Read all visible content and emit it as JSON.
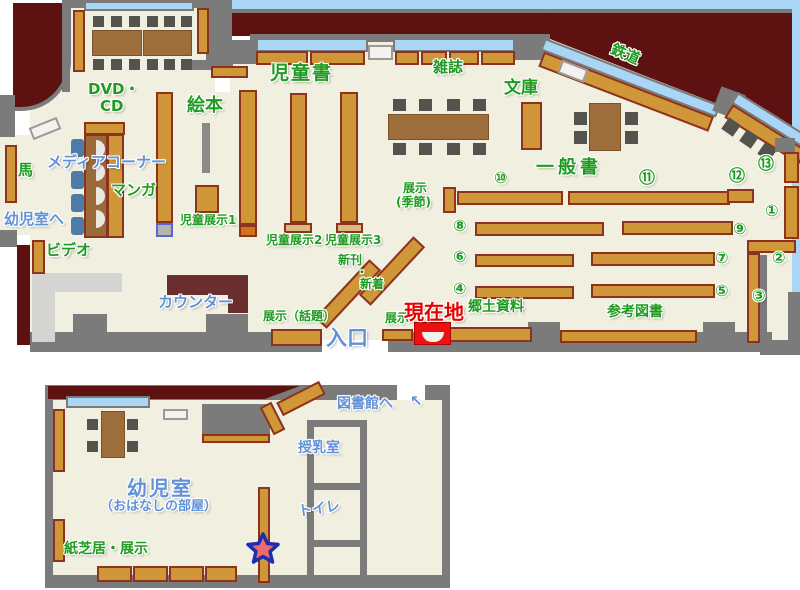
{
  "colors": {
    "outside": "#5e1111",
    "floor": "#f0efe0",
    "wall": "#7b7b7b",
    "window": "#a9d6f5",
    "shelf": "#cf9738",
    "shelf_border": "#8e3220",
    "table": "#9d6e3c",
    "chair": "#55534e",
    "media_chair": "#4d7ca8",
    "counter": "#6b2e2e",
    "light_area": "#d4d4d2",
    "label_green": "#1f9b1f",
    "label_blue": "#6191d8",
    "label_red": "#e60000",
    "current_location_marker": "#ee1111",
    "star_fill": "#ef6a6a",
    "star_outline": "#1b2db0"
  },
  "main_floor": {
    "labels": {
      "jidosho": "児童書",
      "zasshi": "雑誌",
      "bunko": "文庫",
      "tetsudo": "鉄道",
      "ippansho": "一般書",
      "dvd_line1": "DVD・",
      "dvd_line2": "CD",
      "ehon": "絵本",
      "uma": "馬",
      "media_corner": "メディアコーナー",
      "manga": "マンガ",
      "to_yojishitsu": "幼児室へ",
      "video": "ビデオ",
      "jido_tenji1": "児童展示1",
      "jido_tenji2": "児童展示2",
      "jido_tenji3": "児童展示3",
      "shinkan": "新刊",
      "nakaguro": "・",
      "shinchaku": "新着",
      "counter": "カウンター",
      "tenji_wadai": "展示（話題）",
      "iriguchi": "入口",
      "tenji": "展示",
      "genzaichi": "現在地",
      "tenji_kisetsu1": "展示",
      "tenji_kisetsu2": "(季節)",
      "kyodo_shiryo": "郷土資料",
      "sanko_tosho": "参考図書"
    },
    "shelf_numbers": {
      "n1": "①",
      "n2": "②",
      "n3": "③",
      "n4": "④",
      "n5": "⑤",
      "n6": "⑥",
      "n7": "⑦",
      "n8": "⑧",
      "n9": "⑨",
      "n10": "⑩",
      "n11": "⑪",
      "n12": "⑫",
      "n13": "⑬"
    }
  },
  "annex": {
    "labels": {
      "to_library": "図書館へ",
      "junyushitsu": "授乳室",
      "toilet": "トイレ",
      "yojishitsu": "幼児室",
      "ohanashi": "（おはなしの部屋）",
      "kamishibai": "紙芝居・展示"
    }
  },
  "icons": {
    "direction_arrow": "↖"
  }
}
